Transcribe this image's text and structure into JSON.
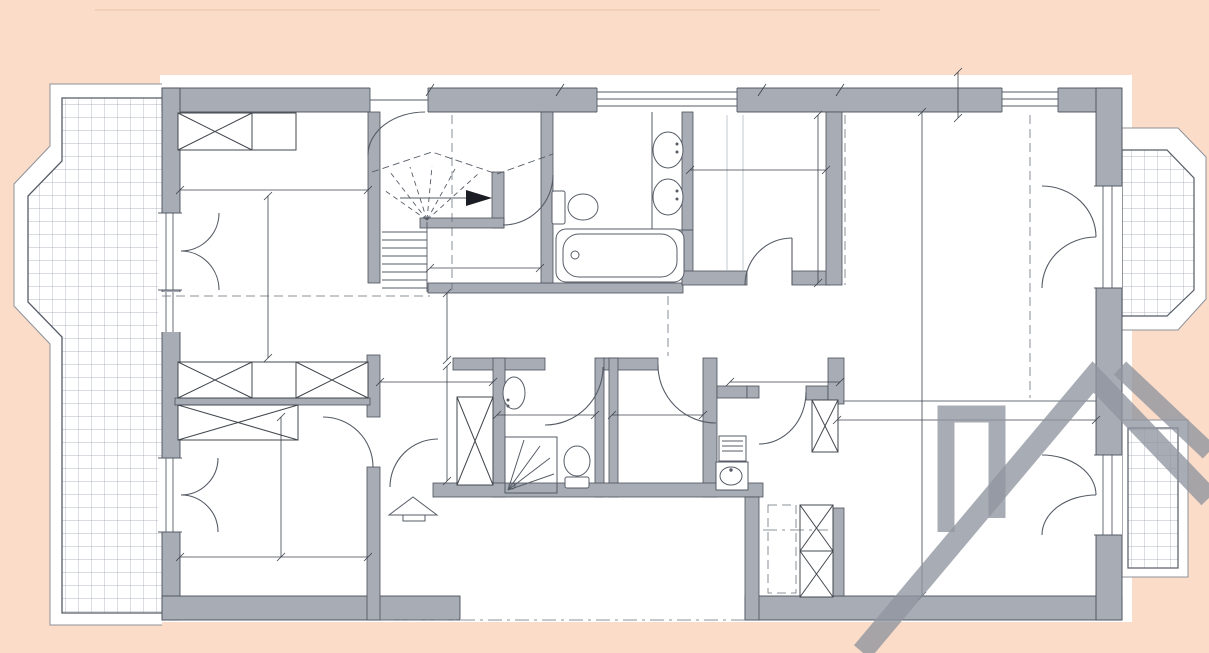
{
  "watermark": {
    "site": "WWW.PROPERTY-FOR-SALE-MONACO.COM"
  },
  "plan": {
    "rooms": [
      {
        "name": "chambre-de-maitre",
        "label": "Chambre de maitre"
      },
      {
        "name": "sdb-maitre",
        "label": "S.d.b Maitre"
      },
      {
        "name": "cage-escalier-commune",
        "label": "cage d'escalier commune"
      },
      {
        "name": "acces-terrasse",
        "label": "Accès vers la terrasse"
      },
      {
        "name": "cuisine",
        "label": "Cuisine"
      },
      {
        "name": "salle-a-manger",
        "label": "Salle à manger"
      },
      {
        "name": "sdb-hotes",
        "label": "S.d.B. Hotes"
      },
      {
        "name": "dressing",
        "label": "Dressing"
      },
      {
        "name": "lingerie",
        "label": "Lingerie"
      },
      {
        "name": "salon",
        "label": "Salon"
      },
      {
        "name": "chambre-dhotes",
        "label": "Chambre d'hotes"
      },
      {
        "name": "entree",
        "label": "Entrée"
      }
    ],
    "dimensions": [
      {
        "context": "chambre-de-maitre-width",
        "value": "3.40"
      },
      {
        "context": "chambre-de-maitre-height",
        "value": "4.90"
      },
      {
        "context": "cage-escalier-width",
        "value": "2.90"
      },
      {
        "context": "cuisine-width",
        "value": "2.55"
      },
      {
        "context": "cuisine-height",
        "value": "3.10"
      },
      {
        "context": "wall-offset",
        "value": "0.50"
      },
      {
        "context": "salle-a-manger-height",
        "value": "8.40"
      },
      {
        "context": "hall-height",
        "value": "1.20"
      },
      {
        "context": "hall-width",
        "value": "2.05"
      },
      {
        "context": "closet-column-height",
        "value": "2.20"
      },
      {
        "context": "sdb-hotes-width",
        "value": "1.80"
      },
      {
        "context": "dressing-width",
        "value": "1.80"
      },
      {
        "context": "lingerie-width",
        "value": "2.05"
      },
      {
        "context": "salon-width",
        "value": "4.55"
      },
      {
        "context": "chambre-dhotes-height",
        "value": "3.40"
      },
      {
        "context": "chambre-dhotes-width",
        "value": "3.40"
      }
    ]
  },
  "colors": {
    "background": "#fbdcc8",
    "sheet": "#ffffff",
    "wall_fill": "#a7acb5",
    "wall_outline": "#4a505a",
    "line": "#565c66",
    "tile_grid": "#9aa3b0",
    "room_label": "#14161d",
    "dimension_text": "#30353d",
    "watermark_text": "#7a808a",
    "watermark_logo": "#8f959f"
  }
}
